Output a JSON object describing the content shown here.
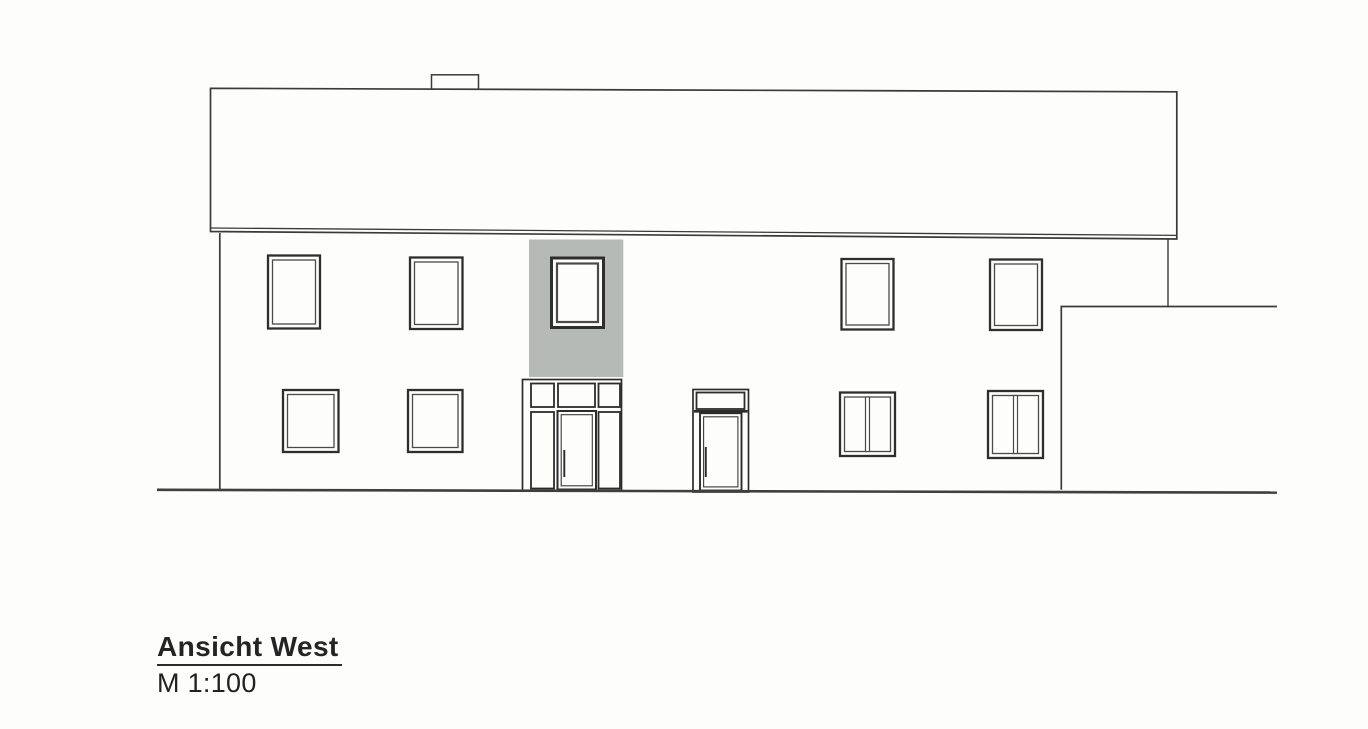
{
  "document": {
    "title": "Ansicht West",
    "scale_label": "M 1:100"
  },
  "colors": {
    "paper": "#fdfdfc",
    "line": "#3a3a3a",
    "line_dark": "#2c2c2c",
    "entrance_bay_gray": "#b6bab7"
  },
  "drawing": {
    "view": "west-elevation",
    "windows": [
      {
        "name": "window-upper-1",
        "x": 268,
        "y": 255.5,
        "w": 52,
        "h": 73,
        "panes": 1
      },
      {
        "name": "window-upper-2",
        "x": 410,
        "y": 257.5,
        "w": 52.5,
        "h": 71.5,
        "panes": 1
      },
      {
        "name": "window-entrance-bay",
        "x": 551.5,
        "y": 258,
        "w": 52,
        "h": 69.5,
        "panes": 1,
        "heavy": true
      },
      {
        "name": "window-upper-3",
        "x": 841.5,
        "y": 259,
        "w": 52,
        "h": 70.5,
        "panes": 1
      },
      {
        "name": "window-upper-4",
        "x": 990,
        "y": 259.5,
        "w": 52,
        "h": 70.5,
        "panes": 1
      },
      {
        "name": "window-ground-1",
        "x": 283,
        "y": 390,
        "w": 55.5,
        "h": 62,
        "panes": 1
      },
      {
        "name": "window-ground-2",
        "x": 408,
        "y": 390,
        "w": 54.5,
        "h": 62,
        "panes": 1
      },
      {
        "name": "window-ground-3",
        "x": 840,
        "y": 392.5,
        "w": 55,
        "h": 63.5,
        "panes": 2
      },
      {
        "name": "window-ground-4",
        "x": 988,
        "y": 391,
        "w": 55,
        "h": 67,
        "panes": 2
      }
    ]
  }
}
